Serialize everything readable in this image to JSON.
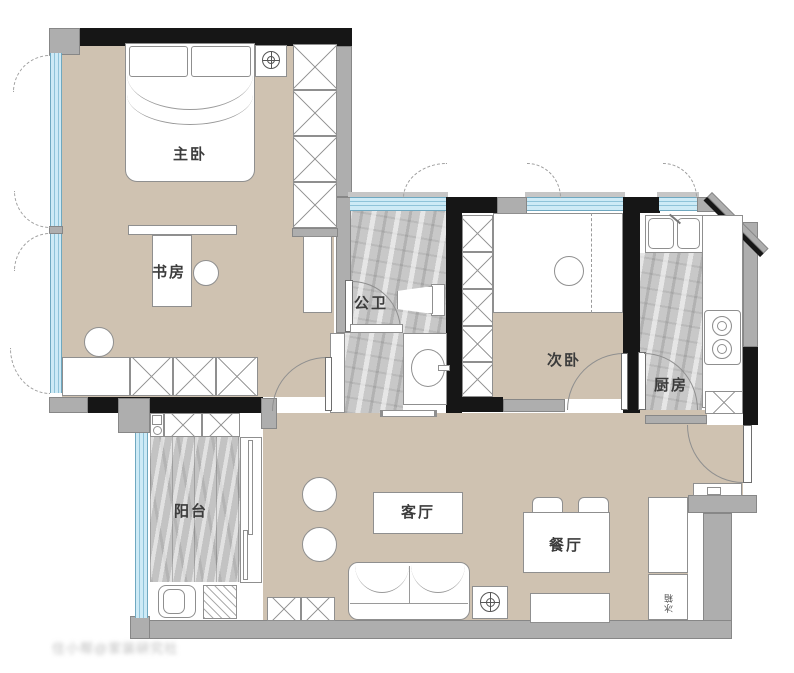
{
  "floor_plan": {
    "rooms": {
      "master_bedroom": {
        "label": "主卧"
      },
      "study": {
        "label": "书房"
      },
      "bathroom": {
        "label": "公卫"
      },
      "second_bedroom": {
        "label": "次卧"
      },
      "kitchen": {
        "label": "厨房"
      },
      "balcony": {
        "label": "阳台"
      },
      "living_room": {
        "label": "客厅"
      },
      "dining_room": {
        "label": "餐厅"
      }
    },
    "annotations": {
      "fridge": "冰箱"
    },
    "watermark": "住小帮@家装研究社",
    "colors": {
      "floor_tan": "#cfc2b1",
      "wall_black": "#161616",
      "wall_gray": "#aeaeae",
      "window_blue": "#cdeaf6",
      "marble_gray": "#c8c8c8"
    }
  }
}
